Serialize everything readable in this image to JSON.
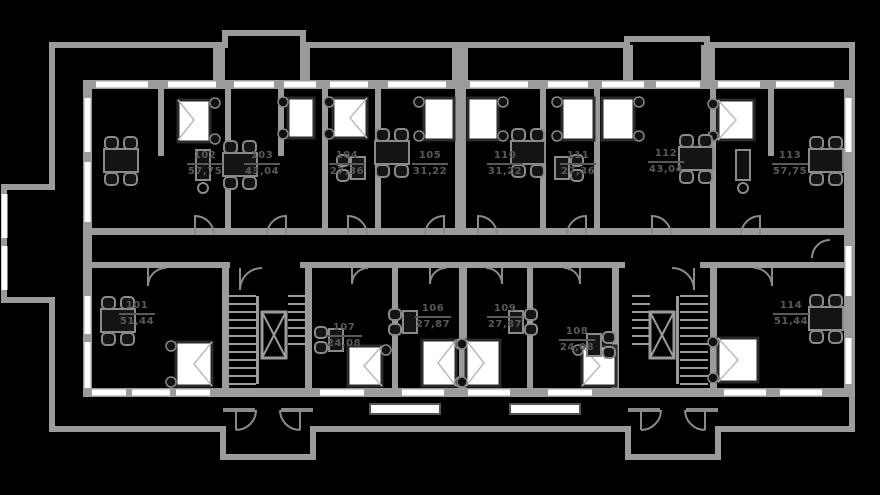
{
  "plan": {
    "type": "apartment-building-floor-plan",
    "colors": {
      "background": "#000000",
      "walls": "#9b9b9b",
      "walls_secondary": "#8a8a8a",
      "windows": "#ffffff",
      "furniture_dark": "#161616",
      "bed_fill": "#ffffff",
      "label_text": "#595959"
    },
    "apartments": [
      {
        "number": "101",
        "area": "51,44"
      },
      {
        "number": "102",
        "area": "57,75"
      },
      {
        "number": "103",
        "area": "43,04"
      },
      {
        "number": "104",
        "area": "27,36"
      },
      {
        "number": "105",
        "area": "31,22"
      },
      {
        "number": "106",
        "area": "27,87"
      },
      {
        "number": "107",
        "area": "24,08"
      },
      {
        "number": "108",
        "area": "24,08"
      },
      {
        "number": "109",
        "area": "27,87"
      },
      {
        "number": "110",
        "area": "31,22"
      },
      {
        "number": "111",
        "area": "27,36"
      },
      {
        "number": "112",
        "area": "43,04"
      },
      {
        "number": "113",
        "area": "57,75"
      },
      {
        "number": "114",
        "area": "51,44"
      }
    ],
    "features": {
      "staircases": 2,
      "elevators": 2,
      "entrance_porches": 2
    }
  }
}
